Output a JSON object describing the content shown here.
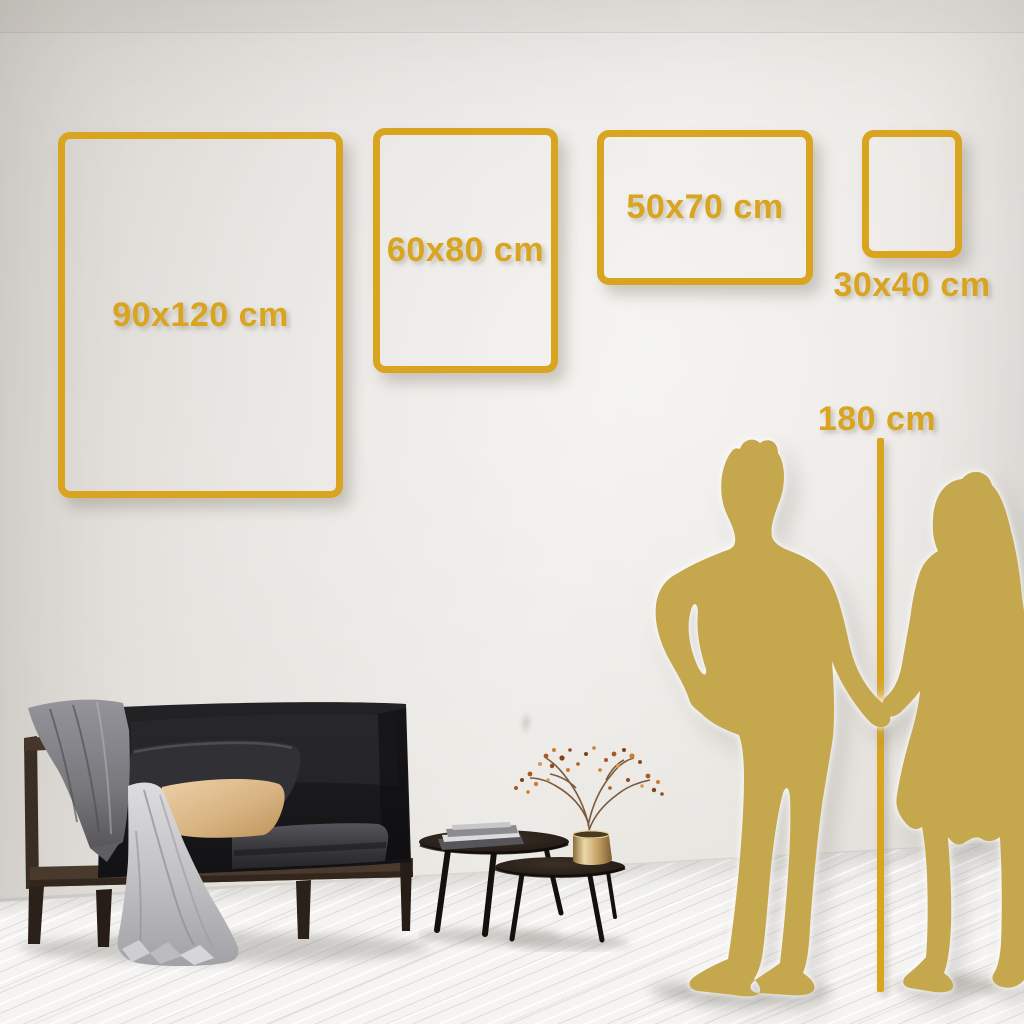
{
  "size_guide": {
    "frames": [
      {
        "label": "90x120 cm",
        "width_cm": 90,
        "height_cm": 120
      },
      {
        "label": "60x80 cm",
        "width_cm": 60,
        "height_cm": 80
      },
      {
        "label": "50x70 cm",
        "width_cm": 50,
        "height_cm": 70
      },
      {
        "label": "30x40 cm",
        "width_cm": 30,
        "height_cm": 40
      }
    ],
    "height_reference": {
      "label": "180 cm",
      "height_cm": 180
    }
  },
  "colors": {
    "accent_gold": "#D9A41F",
    "silhouette_gold": "#C5A84E",
    "wall": "#E3E0DB",
    "floor": "#F2F1EF"
  },
  "scene_elements": [
    "sofa-with-blanket-and-pillows",
    "nesting-coffee-tables",
    "books-stack",
    "brass-vase-with-dried-branch",
    "man-silhouette",
    "woman-silhouette",
    "height-measure-line"
  ]
}
